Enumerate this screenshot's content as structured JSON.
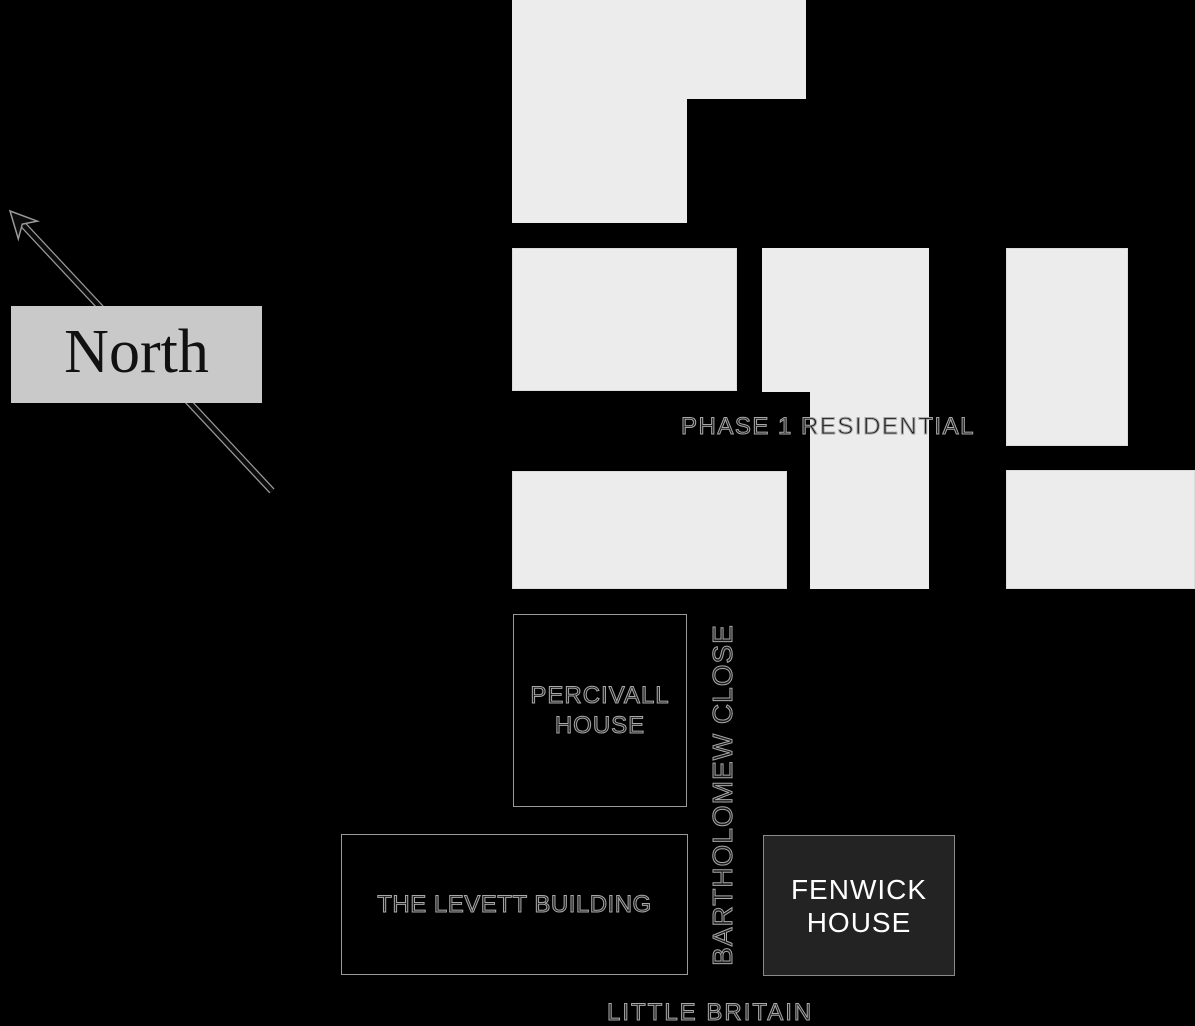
{
  "map": {
    "background": "#000000",
    "north_label": "North",
    "phase1_label": "PHASE 1 RESIDENTIAL",
    "streets": {
      "bartholomew_close": "BARTHOLOMEW CLOSE",
      "little_britain": "LITTLE BRITAIN"
    },
    "buildings": {
      "percivall": {
        "name_line1": "PERCIVALL",
        "name_line2": "HOUSE"
      },
      "levett": {
        "name": "THE LEVETT BUILDING"
      },
      "fenwick": {
        "name_line1": "FENWICK",
        "name_line2": "HOUSE"
      }
    },
    "colors": {
      "building_fill": "#ececec",
      "building_edge": "#dcdcdc",
      "north_box_fill": "#c9c9c9",
      "highlight_box_fill": "#232323",
      "box_outline": "#9a9a9a",
      "label_halo": "#a8a8a8",
      "label_fill": "#1a1a1a",
      "highlight_text": "#ffffff"
    }
  }
}
